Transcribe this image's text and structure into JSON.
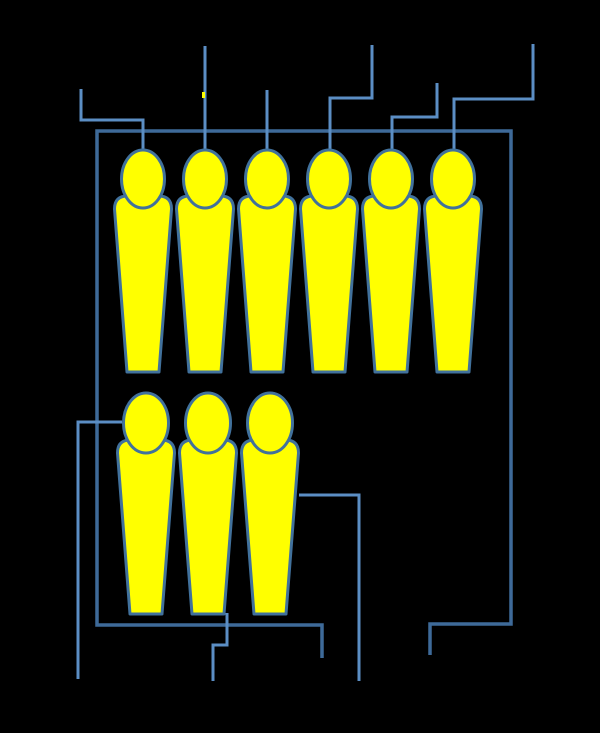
{
  "canvas": {
    "width": 600,
    "height": 733,
    "background": "#000000"
  },
  "colors": {
    "figure_fill": "#FFFF00",
    "figure_outline": "#41719C",
    "callout_line": "#5B8EC4",
    "frame_line": "#3E6A99"
  },
  "figures": {
    "body": {
      "half_top": 28.5,
      "half_bottom": 16,
      "corner": 13
    },
    "rows": [
      {
        "name": "top-row",
        "count": 6,
        "head_cy": 179,
        "head_rx": 21.5,
        "head_ry": 29,
        "body_top_y": 196,
        "body_bottom_y": 372,
        "centers_x": [
          143,
          205,
          267,
          329,
          391,
          453
        ]
      },
      {
        "name": "bottom-row",
        "count": 3,
        "head_cy": 423,
        "head_rx": 22.5,
        "head_ry": 30,
        "body_top_y": 440,
        "body_bottom_y": 614,
        "centers_x": [
          146,
          208,
          270
        ]
      }
    ]
  },
  "connectors": {
    "frame": [
      {
        "name": "frame-outline",
        "stroke_width": 3.5,
        "points": [
          [
            322,
            658
          ],
          [
            322,
            625
          ],
          [
            97,
            625
          ],
          [
            97,
            131
          ],
          [
            511,
            131
          ],
          [
            511,
            624
          ],
          [
            430,
            624
          ],
          [
            430,
            655
          ]
        ]
      }
    ],
    "callouts": [
      {
        "name": "callout-top-1",
        "stroke_width": 3,
        "points": [
          [
            81,
            89
          ],
          [
            81,
            120
          ],
          [
            143,
            120
          ],
          [
            143,
            158
          ]
        ]
      },
      {
        "name": "callout-top-2",
        "stroke_width": 3,
        "points": [
          [
            205,
            46
          ],
          [
            205,
            158
          ]
        ]
      },
      {
        "name": "callout-top-3",
        "stroke_width": 3,
        "points": [
          [
            267,
            90
          ],
          [
            267,
            158
          ]
        ]
      },
      {
        "name": "callout-top-4",
        "stroke_width": 3,
        "points": [
          [
            372,
            45
          ],
          [
            372,
            98
          ],
          [
            330,
            98
          ],
          [
            330,
            158
          ]
        ]
      },
      {
        "name": "callout-top-5",
        "stroke_width": 3,
        "points": [
          [
            437,
            83
          ],
          [
            437,
            117
          ],
          [
            392,
            117
          ],
          [
            392,
            158
          ]
        ]
      },
      {
        "name": "callout-top-6",
        "stroke_width": 3,
        "points": [
          [
            533,
            44
          ],
          [
            533,
            99
          ],
          [
            454,
            99
          ],
          [
            454,
            158
          ]
        ]
      },
      {
        "name": "callout-bottom-left",
        "stroke_width": 3,
        "points": [
          [
            122,
            422
          ],
          [
            78,
            422
          ],
          [
            78,
            679
          ]
        ]
      },
      {
        "name": "callout-bottom-middle",
        "stroke_width": 3,
        "points": [
          [
            227,
            613
          ],
          [
            227,
            645
          ],
          [
            213,
            645
          ],
          [
            213,
            681
          ]
        ]
      },
      {
        "name": "callout-bottom-right",
        "stroke_width": 3,
        "points": [
          [
            299,
            495
          ],
          [
            359,
            495
          ],
          [
            359,
            681
          ]
        ]
      }
    ]
  },
  "artifact_speck": {
    "x": 202,
    "y": 92,
    "width": 3,
    "height": 6
  }
}
